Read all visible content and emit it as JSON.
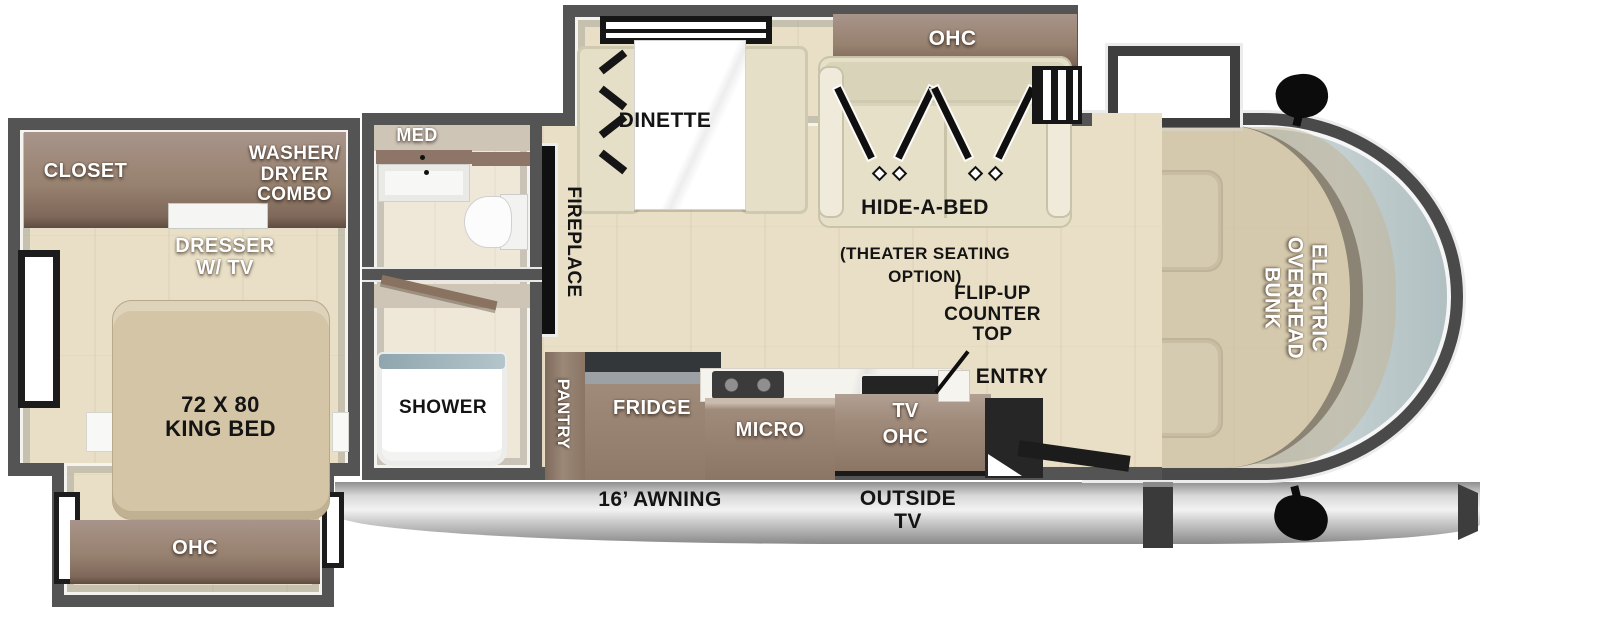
{
  "diagram": {
    "type": "rv-motorhome-floorplan",
    "bedroom": {
      "closet": "CLOSET",
      "washer_dryer": "WASHER/\nDRYER\nCOMBO",
      "dresser": "DRESSER\nW/ TV",
      "king_bed": "72 X 80\nKING BED",
      "ohc": "OHC"
    },
    "bathroom": {
      "med": "MED",
      "shower": "SHOWER"
    },
    "living": {
      "fireplace": "FIREPLACE",
      "dinette": "DINETTE",
      "sofa_ohc": "OHC",
      "hide_a_bed_title": "HIDE-A-BED",
      "hide_a_bed_sub": "(THEATER SEATING\nOPTION)"
    },
    "kitchen": {
      "pantry": "PANTRY",
      "fridge": "FRIDGE",
      "micro": "MICRO",
      "tv_ohc": "TV\nOHC",
      "flip_up_counter": "FLIP-UP\nCOUNTER\nTOP",
      "entry": "ENTRY"
    },
    "cab": {
      "overhead_bunk": "ELECTRIC\nOVERHEAD\nBUNK"
    },
    "exterior": {
      "awning": "16’ AWNING",
      "outside_tv": "OUTSIDE\nTV"
    },
    "colors": {
      "wall": "#545454",
      "floor": "#e9dfc6",
      "cabinet_brown": "#97816f",
      "sofa_beige": "#e6e0c9",
      "bed_tan": "#d3c5a5",
      "windshield_glass": "#b6c3c5",
      "awning_gray": "#c7c7c7",
      "label_white": "#ffffff",
      "label_black": "#141414"
    }
  }
}
